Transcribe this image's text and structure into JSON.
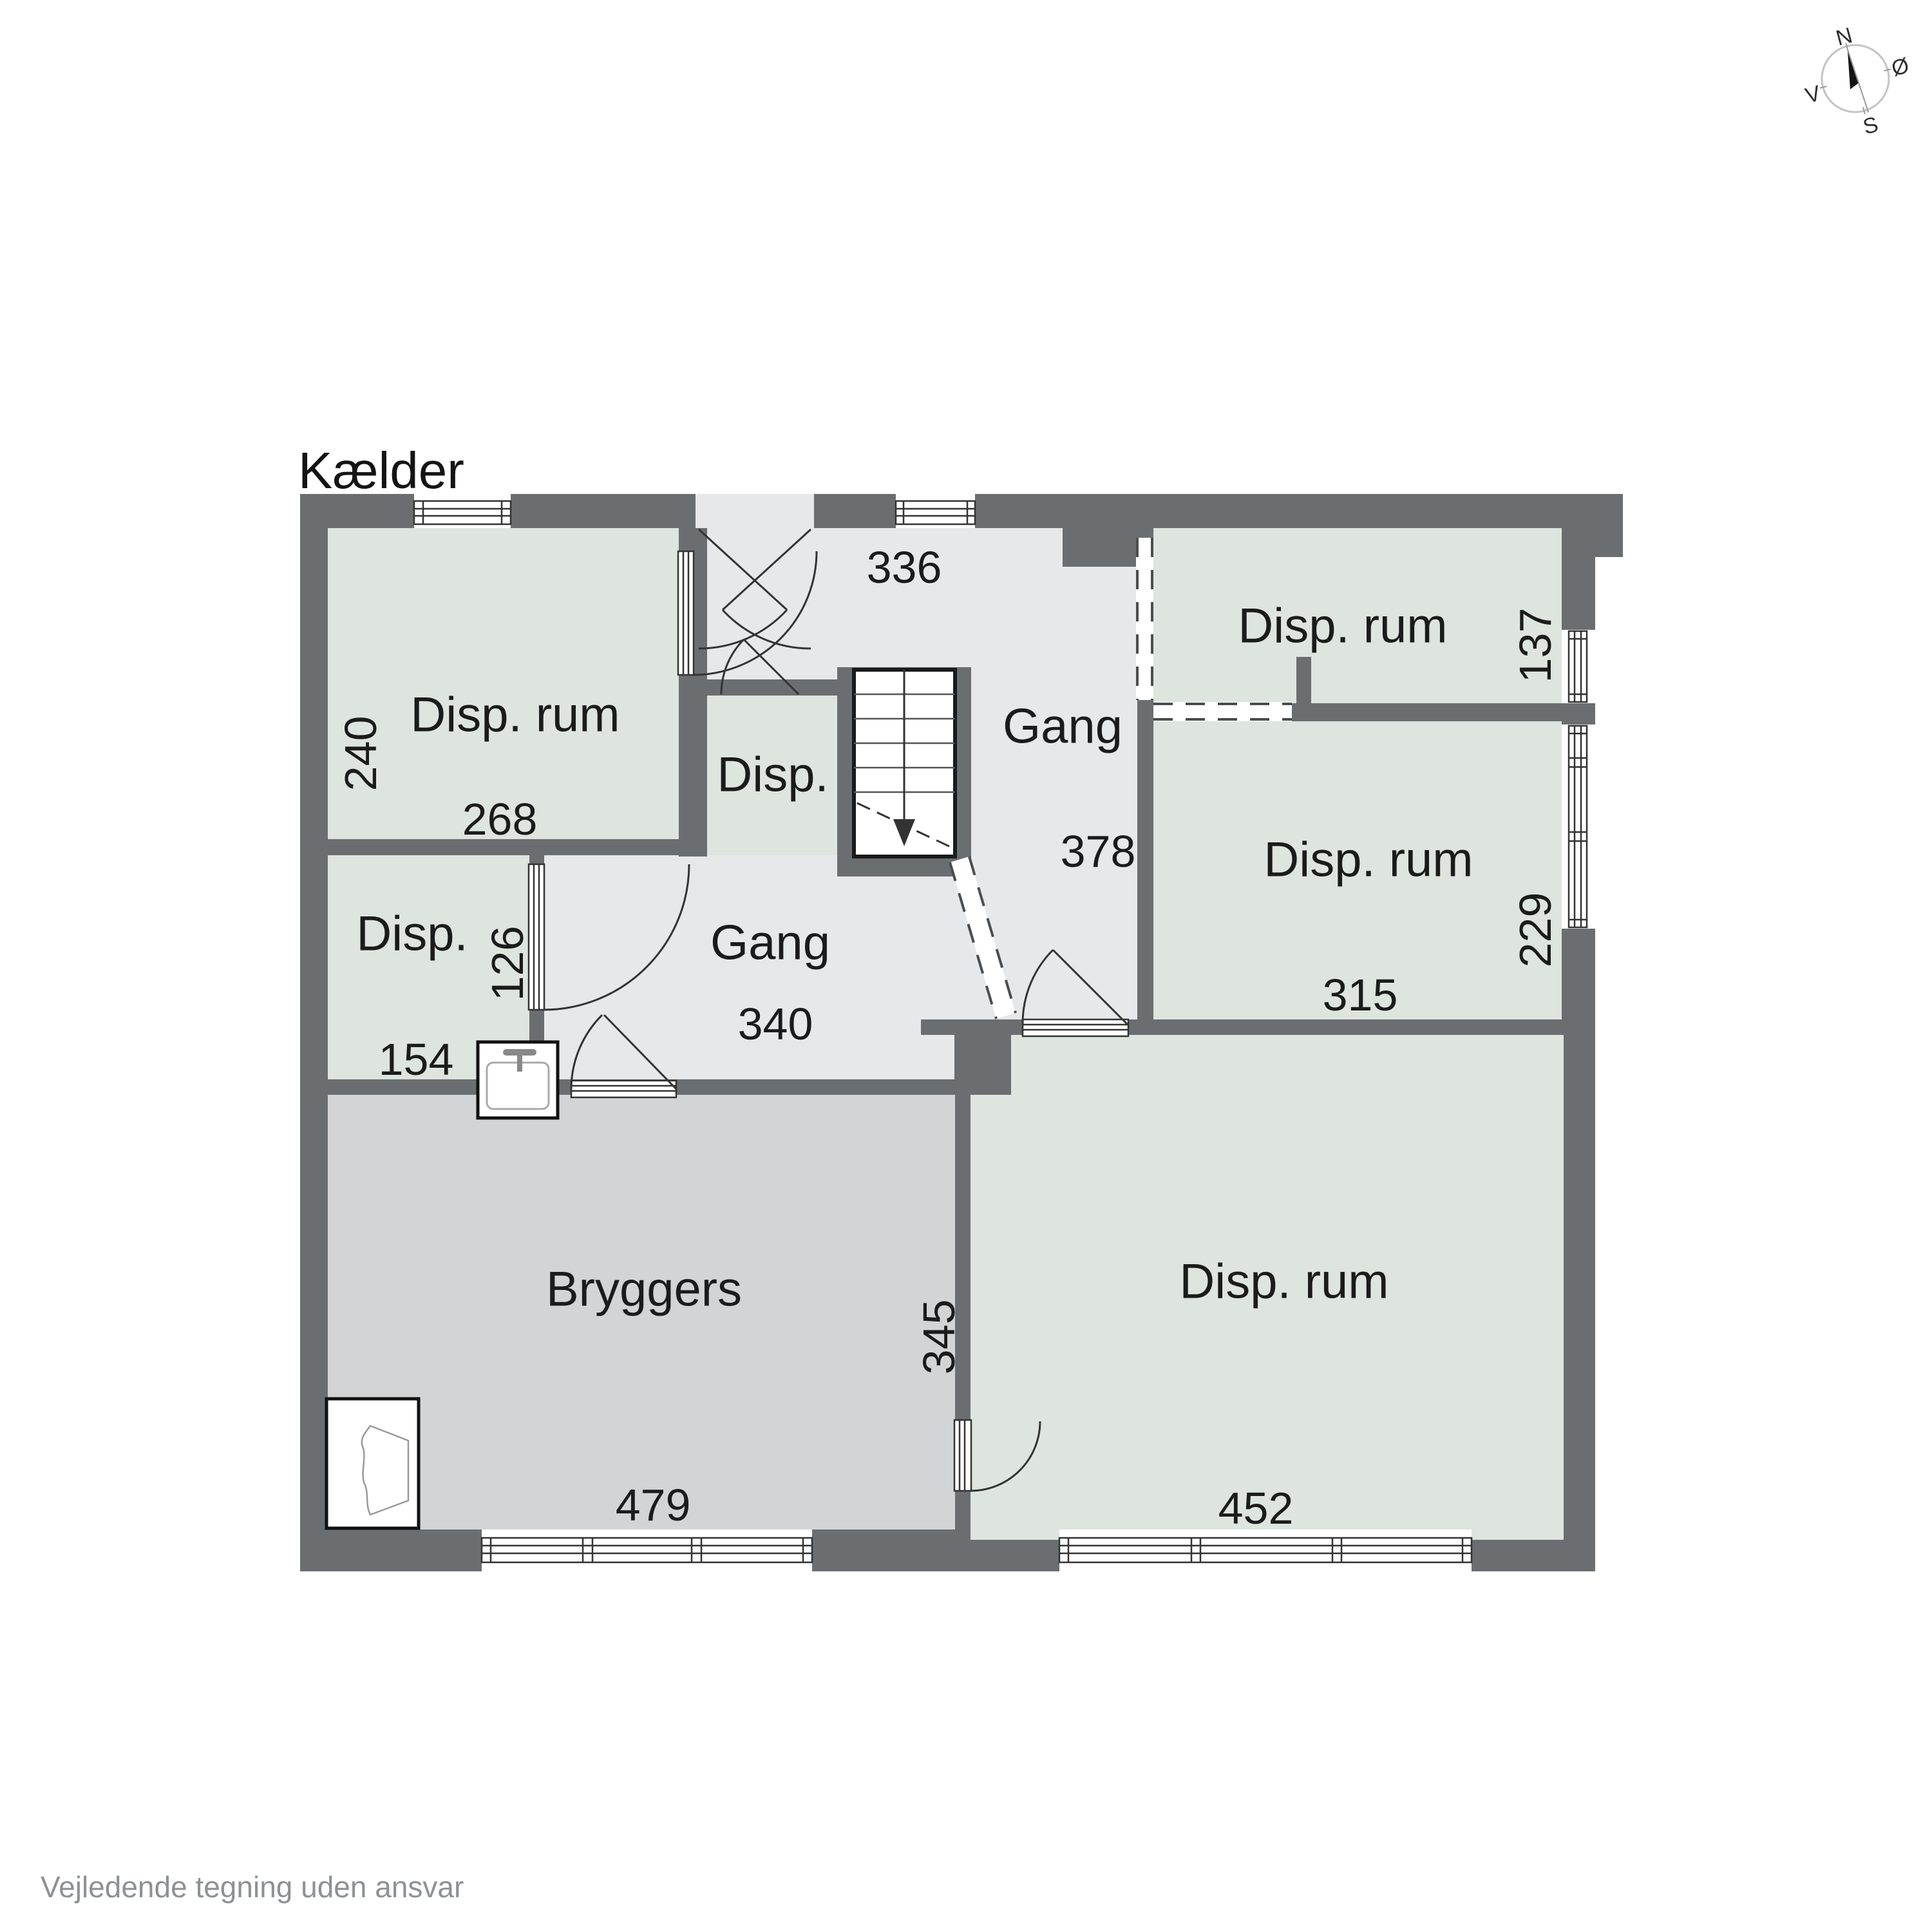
{
  "title": "Kælder",
  "footer": "Vejledende tegning uden ansvar",
  "compass": {
    "north": "N",
    "east": "Ø",
    "south": "S",
    "west": "V"
  },
  "rooms": {
    "disp_rum_top_left": {
      "label": "Disp. rum",
      "width_cm": "268",
      "depth_cm": "240"
    },
    "disp_small": {
      "label": "Disp."
    },
    "disp_left": {
      "label": "Disp.",
      "width_cm": "154",
      "depth_cm": "126"
    },
    "gang_upper": {
      "label": "Gang",
      "width_cm": "336",
      "depth_cm": "378"
    },
    "gang_lower": {
      "label": "Gang",
      "width_cm": "340"
    },
    "disp_rum_top_right": {
      "label": "Disp. rum",
      "depth_cm": "137"
    },
    "disp_rum_mid_right": {
      "label": "Disp. rum",
      "width_cm": "315",
      "depth_cm": "229"
    },
    "disp_rum_bottom_right": {
      "label": "Disp. rum",
      "width_cm": "452",
      "depth_cm": "345"
    },
    "bryggers": {
      "label": "Bryggers",
      "width_cm": "479"
    }
  },
  "colors": {
    "wall": "#6b6e71",
    "room_green": "#dde5de",
    "gang_gray": "#e6e8ea",
    "bryggers_gray": "#d3d4d6",
    "line": "#333333",
    "footer_text": "#8e9194"
  }
}
